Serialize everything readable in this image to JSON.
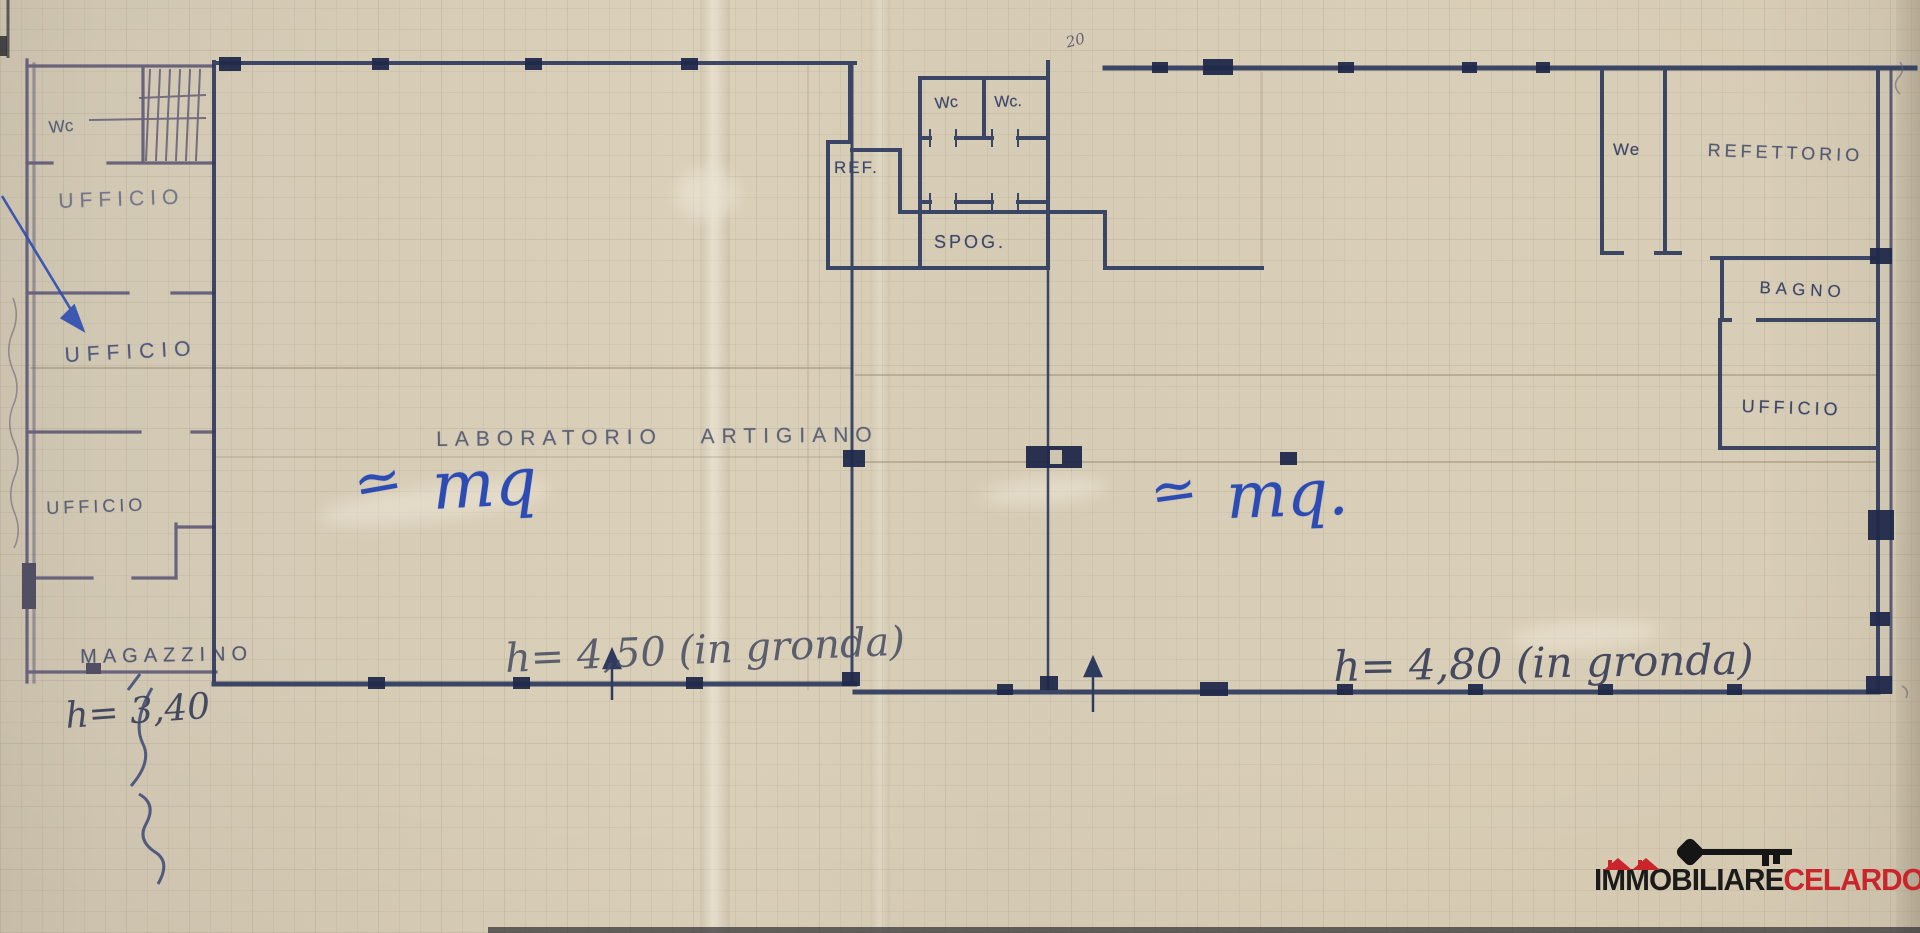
{
  "plan": {
    "rooms": {
      "wc_left": "Wc",
      "ufficio_1": "UFFICIO",
      "ufficio_2": "UFFICIO",
      "ufficio_3": "UFFICIO",
      "magazzino": "MAGAZZINO",
      "laboratorio": "LABORATORIO ARTIGIANO",
      "ref": "REF.",
      "wc_center_1": "Wc",
      "wc_center_2": "Wc.",
      "spog": "SPOG.",
      "we_right": "We",
      "refettorio": "REFETTORIO",
      "bagno": "BAGNO",
      "ufficio_right": "UFFICIO"
    },
    "annotations": {
      "approx_left": "≃",
      "mq_left": "mq",
      "approx_right": "≃",
      "mq_right": "mq.",
      "height_left_hall": "h= 4,50 (in gronda)",
      "height_right_hall": "h= 4,80 (in gronda)",
      "height_magazzino": "h= 3,40",
      "top_number": "20"
    }
  },
  "watermark": {
    "brand_black": "IMMOBILIARE",
    "brand_red": "CELARDO",
    "registered": "®"
  },
  "colors": {
    "paper": "#d3c8b1",
    "wall_ink": "#2e3a5e",
    "blue_ink": "#2c4cb3",
    "logo_red": "#c9252b"
  }
}
